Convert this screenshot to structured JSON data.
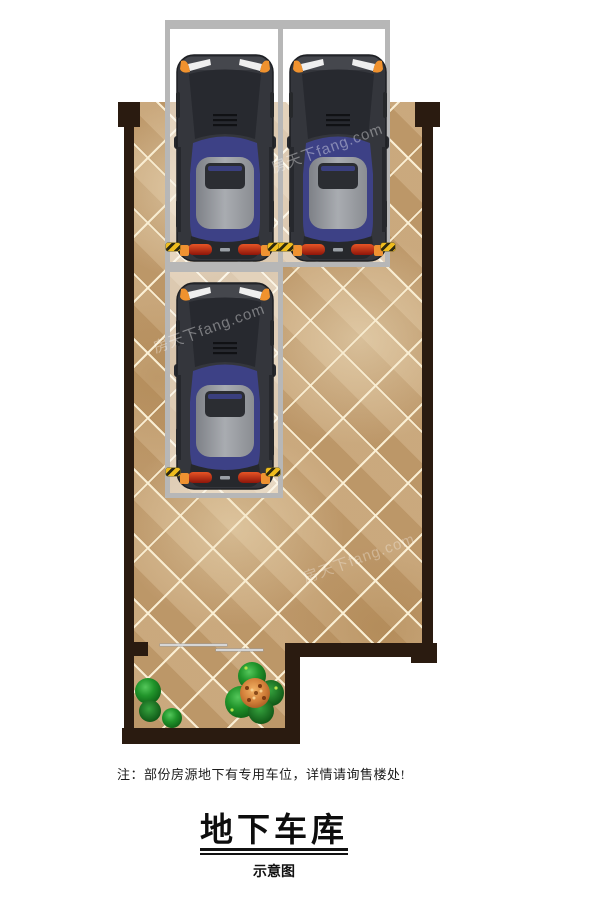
{
  "title_block": {
    "note": "注：部份房源地下有专用车位，详情请询售楼处!",
    "title": "地下车库",
    "subtitle": "示意图"
  },
  "watermark": {
    "text": "房天下fang.com"
  },
  "plan": {
    "type": "underground-garage-floor-plan",
    "parking_space_count": 3,
    "car_count": 3,
    "shrub_count": 4,
    "colors": {
      "wall": "#2a1b10",
      "floor_tile": "#c39e70",
      "tile_grout": "#f2e6ca",
      "parking_space_border": "#b7b7b7",
      "parking_space_fill": "rgba(255,255,255,0.48)",
      "car_body": "#34363c",
      "car_cabin_blue": "#3d4186",
      "car_roof_gray": "#969a9f",
      "car_accent_orange": "#f0922e",
      "taillight_red": "#c23318",
      "wheel_stop_yellow": "#eebc1e",
      "shrub_green": "#21952b",
      "flower_orange": "#d2803a"
    }
  }
}
